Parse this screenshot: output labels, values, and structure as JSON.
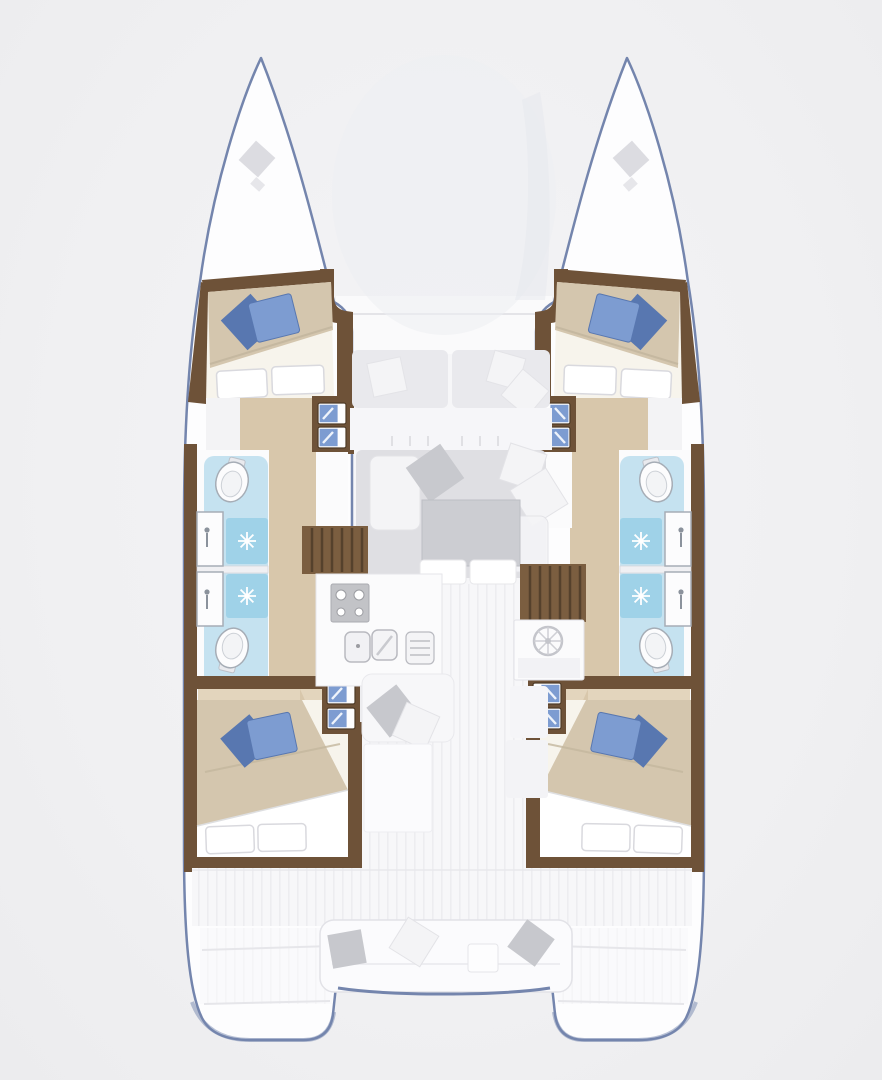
{
  "plan": {
    "type": "catamaran-interior-floor-plan-top-view",
    "orientation": "bow-up",
    "hulls": [
      "port",
      "starboard"
    ],
    "per_hull_rooms": [
      "fore-cabin-double-bed",
      "fore-bathroom",
      "aft-bathroom",
      "aft-cabin-double-bed"
    ],
    "center_rooms": [
      "foredeck-bench",
      "salon-front-bench",
      "salon-lounge-with-table",
      "galley",
      "nav-helm-station",
      "cockpit",
      "aft-cockpit-bench"
    ],
    "fixture_counts": {
      "cabins": 4,
      "bathrooms": 4,
      "toilets": 4,
      "showers": 4,
      "washbasins": 4,
      "double_beds": 4,
      "blue_pillows_per_bed": 2,
      "companionway_stairs": 2
    }
  },
  "icons": {
    "shower_drain": "starburst-rays",
    "toilet": "oval-bowl-with-tank",
    "washbasin_faucet": "dot-and-line",
    "stove": "four-burner-circles",
    "galley_sink": "double-rounded-basins",
    "helm": "wheel-with-spokes",
    "anchor_locker": "gray-diamond-hatch",
    "bed_pillows": "rotated-blue-squares",
    "seat_pillows": "rotated-white-and-gray-squares"
  },
  "colors": {
    "background": "#f1f1f3",
    "hull_fill": "#fdfdfe",
    "hull_outline": "#7485ad",
    "deck": "#f6f6f8",
    "deck_stripe": "#ededf0",
    "wood_trim": "#6e5238",
    "wood_trim_dark": "#4e3b27",
    "floor_wood": "#d8c7ab",
    "floor_wood_light": "#e3d5bd",
    "stairs": "#7b5e40",
    "stairs_line": "#55412c",
    "bed_blanket": "#d4c6ae",
    "bed_sheet": "#ffffff",
    "pillow_blue": "#7d9cd1",
    "pillow_blue_dark": "#5877b0",
    "bath_floor": "#c5e2f0",
    "shower_floor": "#9fd2e8",
    "fixture_white": "#fcfcfd",
    "fixture_outline": "#a6adb6",
    "sofa_gray": "#dfdfe3",
    "table_gray": "#cccdd2",
    "pillow_gray": "#c7c8cd",
    "pillow_white": "#f4f4f6",
    "counter_white": "#fbfbfc",
    "appliance_gray": "#c2c3c7"
  }
}
